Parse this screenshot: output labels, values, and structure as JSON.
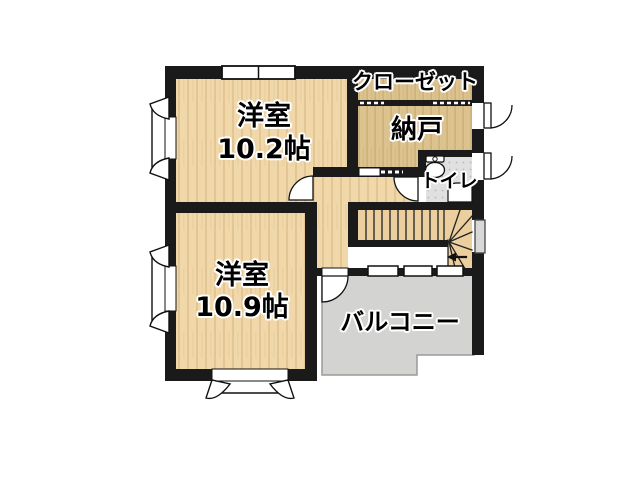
{
  "floorplan": {
    "rooms": [
      {
        "id": "bedroom-upper",
        "label": "洋室",
        "area": "10.2帖"
      },
      {
        "id": "bedroom-lower",
        "label": "洋室",
        "area": "10.9帖"
      },
      {
        "id": "closet",
        "label": "クローゼット"
      },
      {
        "id": "storeroom",
        "label": "納戸"
      },
      {
        "id": "toilet",
        "label": "トイレ"
      },
      {
        "id": "balcony",
        "label": "バルコニー"
      }
    ],
    "colors": {
      "wall": "#1a1a1a",
      "wood_floor": "#f1d8ab",
      "wood_floor_dark": "#dcc28f",
      "stairs": "#eccf9f",
      "tile_floor": "#e0e0e0",
      "balcony": "#d3d3d1",
      "background": "#ffffff"
    }
  }
}
